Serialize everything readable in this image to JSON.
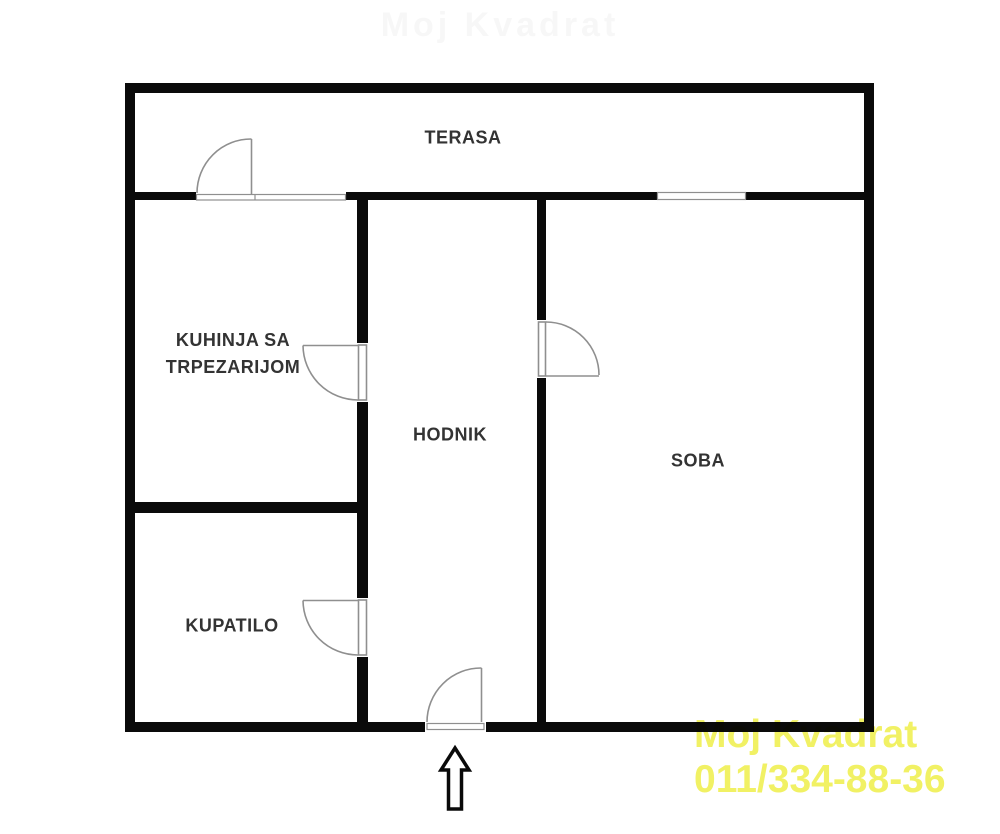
{
  "page": {
    "background": "#ffffff"
  },
  "floorplan": {
    "rooms": {
      "terasa": {
        "label": "TERASA"
      },
      "kuhinja": {
        "label_line1": "KUHINJA SA",
        "label_line2": "TRPEZARIJOM"
      },
      "hodnik": {
        "label": "HODNIK"
      },
      "soba": {
        "label": "SOBA"
      },
      "kupatilo": {
        "label": "KUPATILO"
      }
    },
    "features": {
      "doors": [
        "terrace-door",
        "kitchen-door",
        "bathroom-door",
        "room-door",
        "entry-door"
      ],
      "windows": [
        "terrace-opening-window",
        "room-terrace-window"
      ],
      "entrance_arrow_direction": "up"
    },
    "colors": {
      "wall": "#0a0a0a",
      "door_line": "#8f8f8f",
      "label_text": "#333333"
    }
  },
  "watermark": {
    "line1": "Moj Kvadrat",
    "line2": "011/334-88-36",
    "color": "#f1f164"
  },
  "faint_top_watermark": {
    "text": "Moj Kvadrat"
  }
}
